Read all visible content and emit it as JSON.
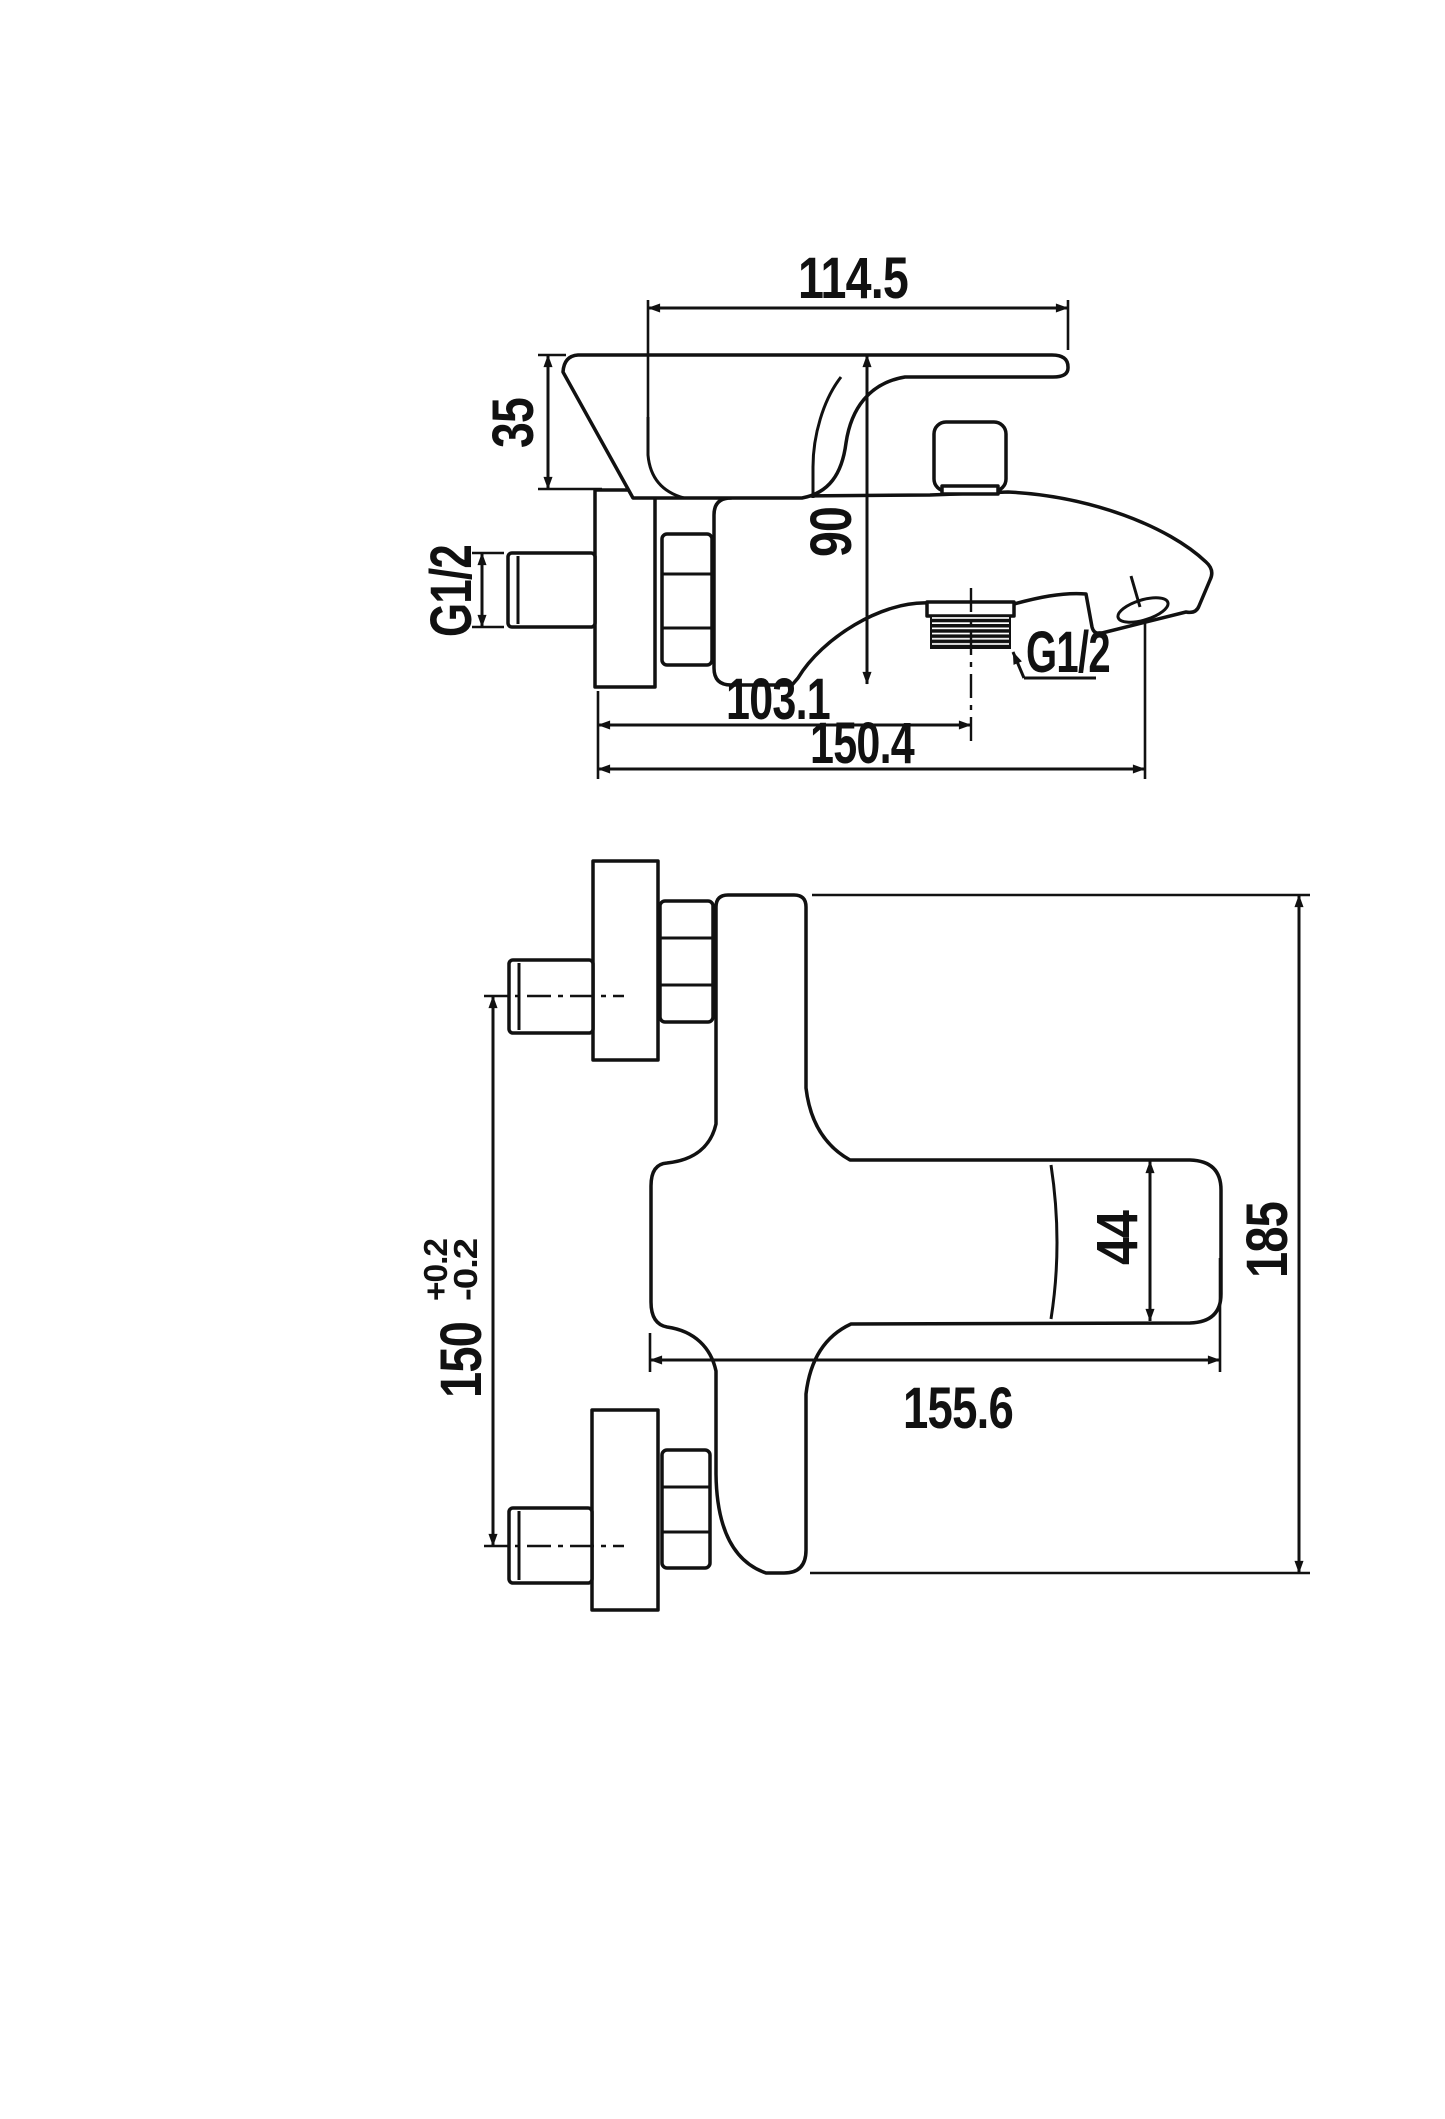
{
  "page": {
    "background": "#ffffff",
    "ink": "#111111"
  },
  "side_view": {
    "dim_top_width": "114.5",
    "dim_handle_height": "35",
    "dim_body_height": "90",
    "inlet_thread_label": "G1/2",
    "dim_outlet_offset": "103.1",
    "dim_total_reach": "150.4",
    "outlet_thread_label": "G1/2"
  },
  "front_view": {
    "dim_pipe_spacing": "150",
    "tol_plus": "+0.2",
    "tol_minus": "-0.2",
    "dim_body_diameter": "44",
    "dim_overall_length": "185",
    "dim_body_length": "155.6"
  }
}
